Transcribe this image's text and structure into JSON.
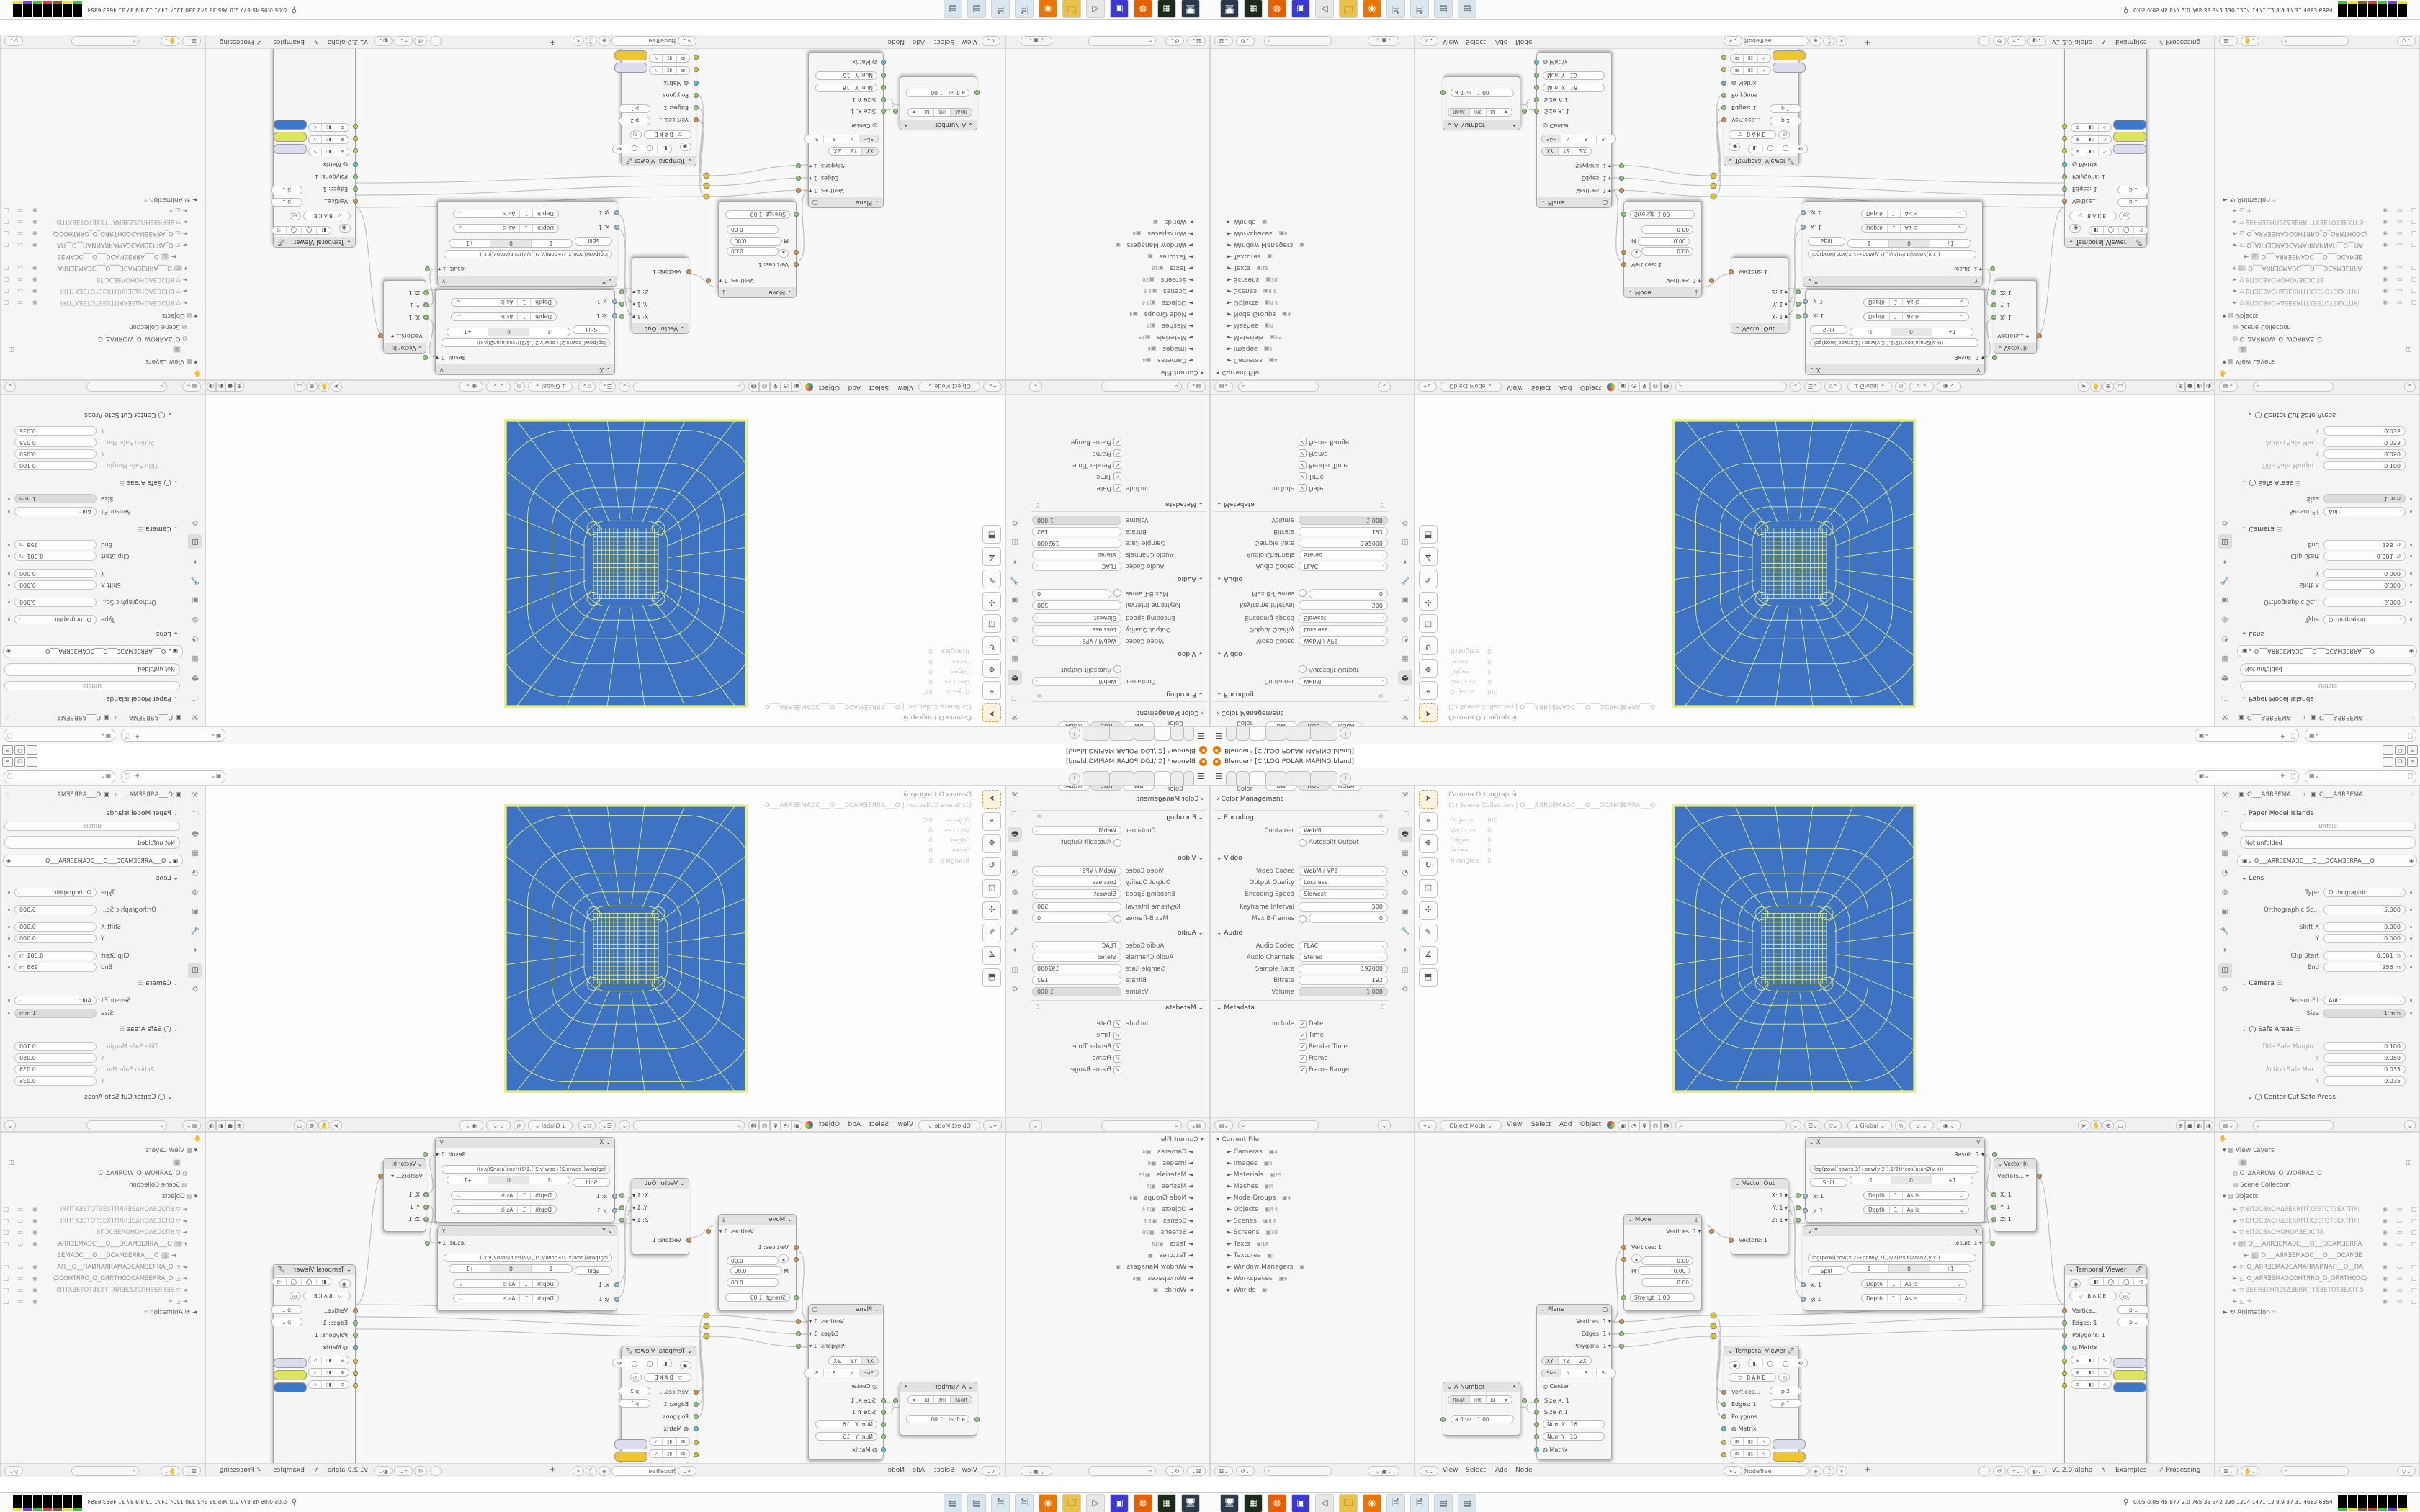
{
  "window": {
    "title": "Blender* [C:\\LOG POLAR MAPING.blend]",
    "minimize": "–",
    "maximize": "❐",
    "close": "✕"
  },
  "topbar": {
    "tabs": [
      "",
      "",
      "",
      "",
      "",
      ""
    ],
    "add_tab": "+"
  },
  "output_props": {
    "color_label": "Color",
    "color_options": [
      "BW",
      "RGB",
      "RGBA"
    ],
    "color_management": "Color Management",
    "encoding": "Encoding",
    "container_label": "Container",
    "container_value": "WebM",
    "autosplit_label": "Autosplit Output",
    "video": "Video",
    "video_rows": [
      {
        "label": "Video Codec",
        "value": "WebM / VP9",
        "kind": "select"
      },
      {
        "label": "Output Quality",
        "value": "Lossless",
        "kind": "select"
      },
      {
        "label": "Encoding Speed",
        "value": "Slowest",
        "kind": "select"
      },
      {
        "label": "Keyframe Interval",
        "value": "500",
        "kind": "num"
      },
      {
        "label": "Max B-frames",
        "value": "0",
        "kind": "numtoggle"
      }
    ],
    "audio": "Audio",
    "audio_rows": [
      {
        "label": "Audio Codec",
        "value": "FLAC",
        "kind": "select"
      },
      {
        "label": "Audio Channels",
        "value": "Stereo",
        "kind": "select"
      },
      {
        "label": "Sample Rate",
        "value": "192000",
        "kind": "num"
      },
      {
        "label": "Bitrate",
        "value": "192",
        "kind": "num"
      },
      {
        "label": "Volume",
        "value": "1.000",
        "kind": "slider"
      }
    ],
    "metadata": "Metadata",
    "include_label": "Include",
    "include_items": [
      "Date",
      "Time",
      "Render Time",
      "Frame",
      "Frame Range"
    ]
  },
  "viewport": {
    "overlay_line1": "Camera Orthographic",
    "overlay_line2": "(1) Scene Collection | O___AЯRƎEMAƆC___O___ƆCAMƎERRA___O",
    "stats": [
      [
        "Objects",
        "0/0"
      ],
      [
        "Vertices",
        "0"
      ],
      [
        "Edges",
        "0"
      ],
      [
        "Faces",
        "0"
      ],
      [
        "Triangles",
        "0"
      ]
    ],
    "mode": "Object Mode",
    "menus": [
      "View",
      "Select",
      "Add",
      "Object"
    ],
    "orientation": "Global"
  },
  "camera_props": {
    "breadcrumb_a": "O___AЯRƎEMA...",
    "breadcrumb_sep": "›",
    "breadcrumb_b": "O___AЯRƎEMA...",
    "paper_model": "Paper Model Islands",
    "unfold": "Unfold",
    "not_unfolded": "Not unfolded",
    "camera_name": "O___AЯRƎEMAƆC___O___ƆCAMƎERRA___O",
    "lens": "Lens",
    "lens_rows": [
      {
        "label": "Type",
        "value": "Orthographic",
        "kind": "select"
      },
      {
        "label": "Orthographic Sc...",
        "value": "5.000",
        "kind": "num"
      },
      {
        "label": "Shift X",
        "value": "0.000",
        "kind": "num"
      },
      {
        "label": "Y",
        "value": "0.000",
        "kind": "num"
      },
      {
        "label": "Clip Start",
        "value": "0.001 m",
        "kind": "num"
      },
      {
        "label": "End",
        "value": "256 m",
        "kind": "num"
      }
    ],
    "camera": "Camera",
    "camera_rows": [
      {
        "label": "Sensor Fit",
        "value": "Auto",
        "kind": "select"
      },
      {
        "label": "Size",
        "value": "1 mm",
        "kind": "slider"
      }
    ],
    "safe_areas": "Safe Areas",
    "safe_rows": [
      {
        "label": "Title Safe Margin...",
        "value": "0.100",
        "kind": "dimnum"
      },
      {
        "label": "Y",
        "value": "0.050",
        "kind": "dimnum"
      },
      {
        "label": "Action Safe Mar...",
        "value": "0.035",
        "kind": "dimnum"
      },
      {
        "label": "Y",
        "value": "0.035",
        "kind": "dimnum"
      }
    ],
    "center_cut": "Center-Cut Safe Areas"
  },
  "file_outliner": {
    "root": "Current File",
    "items": [
      {
        "label": "Cameras",
        "count": "4"
      },
      {
        "label": "Images",
        "count": "6"
      },
      {
        "label": "Materials",
        "count": "19"
      },
      {
        "label": "Meshes",
        "count": "4"
      },
      {
        "label": "Node Groups",
        "count": "4"
      },
      {
        "label": "Objects",
        "count": "4 4"
      },
      {
        "label": "Scenes",
        "count": "8 8"
      },
      {
        "label": "Screens",
        "count": "30"
      },
      {
        "label": "Texts",
        "count": "18"
      },
      {
        "label": "Textures",
        "count": ""
      },
      {
        "label": "Window Managers",
        "count": ""
      },
      {
        "label": "Workspaces",
        "count": "6"
      },
      {
        "label": "Worlds",
        "count": ""
      }
    ]
  },
  "node_editor": {
    "menus": [
      "View",
      "Select",
      "Add",
      "Node"
    ],
    "tree_name": "NodeTree",
    "version": "v1.2.0-alpha",
    "examples": "Examples",
    "processing": "Processing",
    "nodes": {
      "a_number": {
        "title": "A Number",
        "type_buttons": [
          "float",
          "int"
        ],
        "value_label": "a float",
        "value": "1.00"
      },
      "plane": {
        "title": "Plane",
        "out1": "Vertices: 1",
        "out2": "Edges: 1",
        "out3": "Polygons: 1",
        "axis": [
          "XY",
          "YZ",
          "ZX"
        ],
        "size_tabs": [
          "Size",
          "N...",
          "S...",
          "Si..."
        ],
        "center": "Center",
        "in1": "Size X: 1",
        "in2": "Size Y: 1",
        "numx_label": "Num X",
        "numx": "16",
        "numy_label": "Num Y",
        "numy": "16",
        "matrix": "Matrix"
      },
      "move": {
        "title": "Move",
        "out": "Vertices: 1",
        "in": "Vertices: 1",
        "m": "M",
        "vec": [
          "0.00",
          "0.00",
          "0.00"
        ],
        "strength_label": "Strengt",
        "strength": "1.00"
      },
      "vector_out": {
        "title": "Vector Out",
        "out1": "X: 1",
        "out2": "Y: 1",
        "out3": "Z: 1",
        "in": "Vectors: 1"
      },
      "x_node": {
        "title": "X",
        "result": "Result: 1",
        "expr": "log(pow((pow(x,2)+pow(y,2)),1/2))*cos(atan2(y,x))",
        "split": "Split",
        "seg": [
          "-1",
          "0",
          "+1"
        ],
        "rows": [
          {
            "s": "x: 1",
            "d1": "Depth",
            "d2": "1",
            "d3": "As is"
          },
          {
            "s": "y: 1",
            "d1": "Depth",
            "d2": "1",
            "d3": "As is"
          }
        ]
      },
      "y_node": {
        "title": "Y",
        "result": "Result: 1",
        "expr": "log(pow((pow(x,2)+pow(y,2)),1/2))*sin(atan2(y,x))",
        "split": "Split",
        "seg": [
          "-1",
          "0",
          "+1"
        ],
        "rows": [
          {
            "s": "x: 1",
            "d1": "Depth",
            "d2": "1",
            "d3": "As is"
          },
          {
            "s": "y: 1",
            "d1": "Depth",
            "d2": "1",
            "d3": "As is"
          }
        ]
      },
      "vector_in": {
        "title": "Vector In",
        "out": "Vectors...",
        "in1": "X: 1",
        "in2": "Y: 1",
        "in3": "Z: 1"
      },
      "tv1": {
        "title": "Temporal Viewer",
        "bake": "BAKE",
        "r1": "Vertices...",
        "r1v": "p  2",
        "r2": "Edges: 1",
        "r2v": "p  1",
        "r3": "Polygons",
        "r4": "Matrix"
      },
      "tv2": {
        "title": "Temporal Viewer",
        "bake": "BAKE",
        "r1": "Vertice...",
        "r1v": "p  1",
        "r2": "Edges: 1",
        "r2v": "p  1",
        "r3": "Polygons: 1",
        "r4": "Matrix"
      }
    }
  },
  "scene_outliner": {
    "view_layers": "View Layers",
    "world": "O_ΔΛЯROW_O_WOЯRΛΔ_O",
    "scene_collection": "Scene Collection",
    "objects": "Objects",
    "children": [
      {
        "label": "8ΠƆCƎΛOHΔƎERRΠTXƎETOTƎEXTΠЯI",
        "icon": "mesh"
      },
      {
        "label": "8ΠƆCƎΛOHΔƎERRΠTXƎETOTƎEXTΠЯI",
        "icon": "mesh"
      },
      {
        "label": "8ΠƆCƎΛOHOHOΛƎEƆCΠ8",
        "icon": "mesh"
      },
      {
        "label": "O___AЯRƎEMAƆC___O___ƆCAMƎERRA",
        "icon": "camera",
        "active": true
      },
      {
        "label": "O___AЯRƎEMAƆC___O___ƆCAMƎE",
        "icon": "camera-data",
        "child": true
      },
      {
        "label": "O_AЯRƎEMAƆCAMAЯRAИNAΠ__O__ΠA",
        "icon": "camera"
      },
      {
        "label": "O_AЯRƎEMAƆCOHTЯRO_O_OЯRTHOƆC/",
        "icon": "camera"
      },
      {
        "label": "ƎEЯRƎEHΠ2SΔƎERRΠTXƎETOTƎEXTΠ5",
        "icon": "mesh"
      },
      {
        "label": "✳",
        "icon": "camera"
      }
    ],
    "animation": "Animation"
  },
  "taskbar": {
    "icons": [
      "display-settings",
      "device-manager",
      "firefox",
      "vice-c64",
      "volume",
      "folder",
      "blender",
      "notepad",
      "notepad",
      "calculator",
      "calculator"
    ],
    "tray_numbers": "0.05 0.05  45  877  2.0  765  33  342 330 1204 1471  12  8.9  37  31  4683 6354"
  },
  "colors": {
    "render_blue": "#3e72c2",
    "wire_yellow": "#dce97c",
    "outline_yellow": "#e6f089",
    "swatch_lavender": "#dcdcef",
    "swatch_gold": "#eec52c",
    "swatch_yellowgreen": "#dbe45a",
    "swatch_blue": "#3d78c8",
    "socket_orange": "#e08d3c",
    "socket_green": "#86d167",
    "socket_cyan": "#53c4d8",
    "socket_yellow": "#d9c42a"
  }
}
